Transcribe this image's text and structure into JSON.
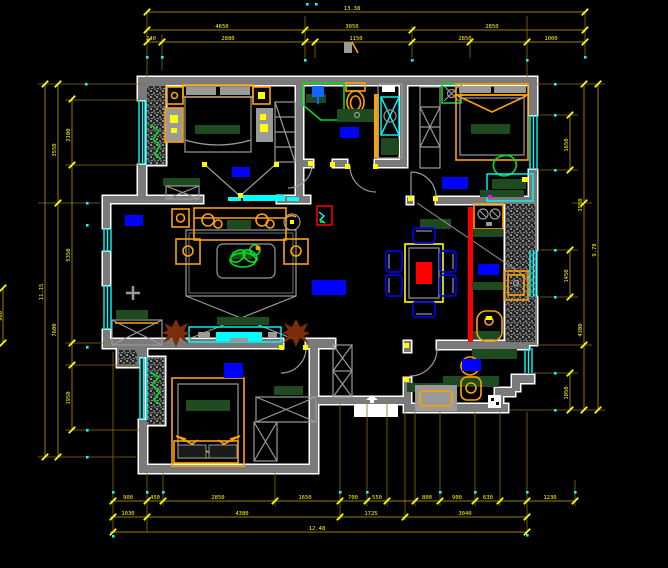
{
  "drawing_title": "apartment-floor-plan",
  "colors": {
    "background": "#000000",
    "wall": "#7a7a7a",
    "wall_outline": "#ffffff",
    "window": "#00ffff",
    "dimension": "#ffff00",
    "room_label_block": "#0000ff",
    "furniture_accent": "#ffa200",
    "cushion": "#1d4a1f",
    "slider_door": "#ff0000",
    "plant": "#7c2d0c"
  },
  "dims": {
    "top": {
      "overall": "13.38",
      "r2": [
        "4650",
        "3050",
        "2850"
      ],
      "r3": [
        "240",
        "2880",
        "1150",
        "2850",
        "1000"
      ]
    },
    "bottom": {
      "r1": [
        "900",
        "450",
        "2850",
        "1650",
        "700",
        "550",
        "800",
        "900",
        "630",
        "1230"
      ],
      "r2": [
        "1030",
        "4380",
        "1725",
        "3040"
      ],
      "overall": "12.48"
    },
    "left": {
      "overall": "11.15",
      "mid": [
        "3550",
        "7600"
      ],
      "inner": [
        "2100",
        "5350",
        "1950"
      ],
      "small": "900"
    },
    "right": {
      "inner": [
        "1650",
        "1450",
        "1050"
      ],
      "mid": [
        "3950",
        "4300"
      ],
      "overall": "9.78"
    }
  }
}
